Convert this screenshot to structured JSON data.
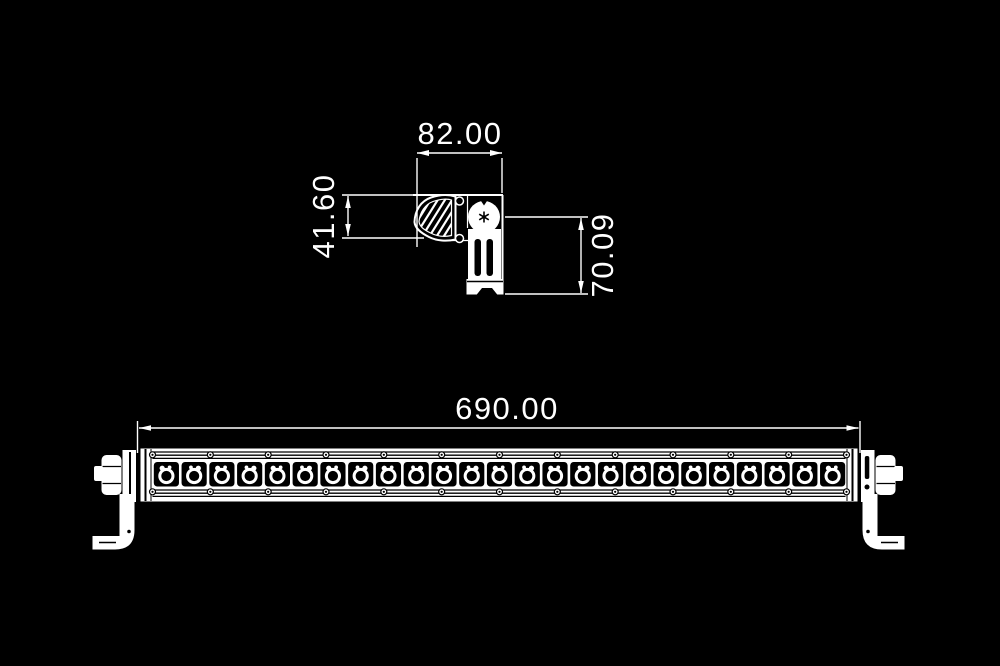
{
  "colors": {
    "background": "#000000",
    "line": "#ffffff"
  },
  "side_view": {
    "width_dim": "82.00",
    "height_dim": "41.60",
    "bracket_height_dim": "70.09"
  },
  "front_view": {
    "length_dim": "690.00",
    "led_count": 25,
    "screw_count": 13,
    "hatch_count": 8
  }
}
